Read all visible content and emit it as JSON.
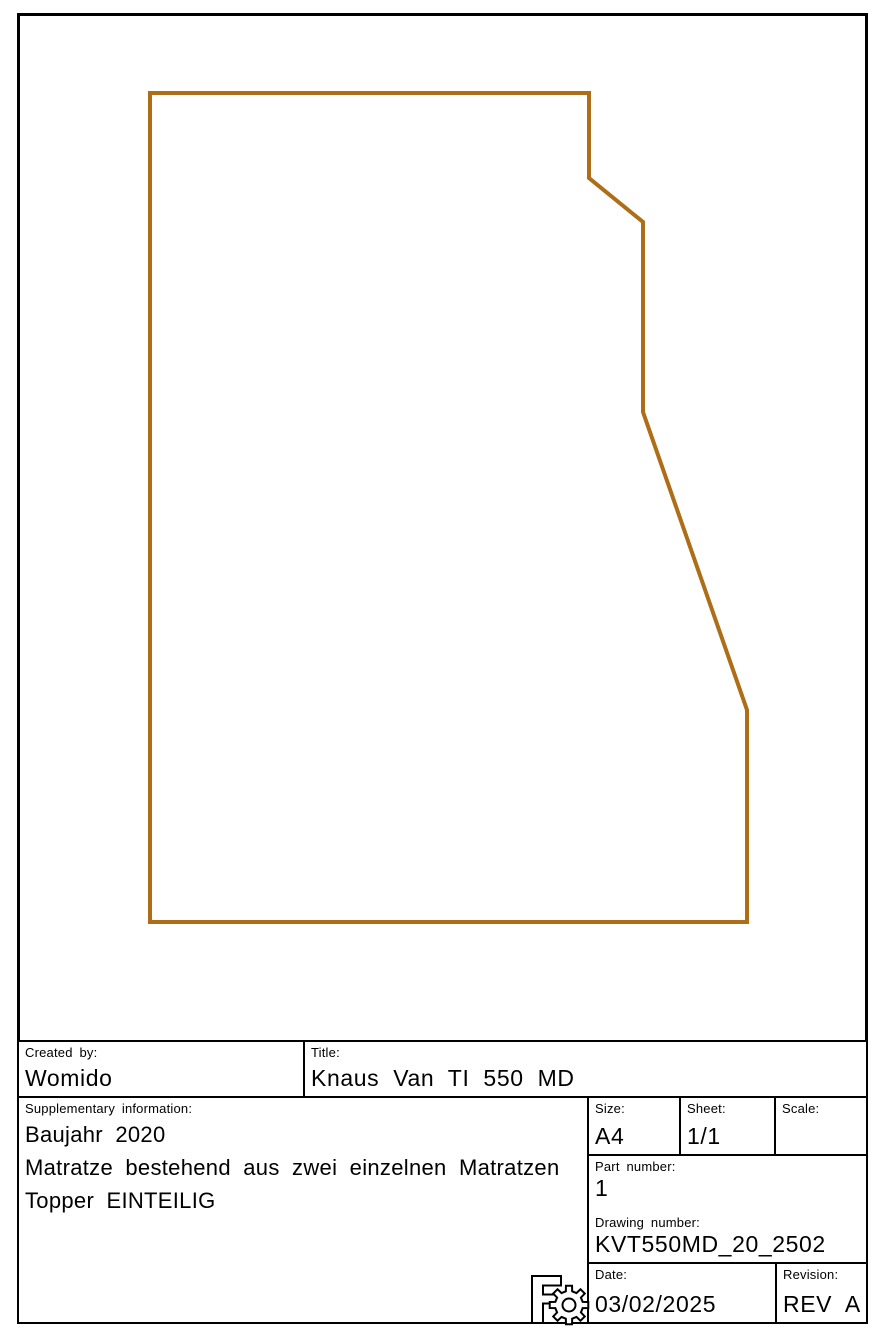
{
  "drawing": {
    "outline_color": "#AE6E17",
    "outline_points": "150,93 589,93 589,178 643,222 643,412 747,710 747,922 150,922",
    "outline_stroke_width": "4"
  },
  "title_block": {
    "created_by": {
      "label": "Created by:",
      "value": "Womido"
    },
    "title": {
      "label": "Title:",
      "value": "Knaus Van TI 550 MD"
    },
    "supplementary": {
      "label": "Supplementary information:",
      "lines": [
        "Baujahr 2020",
        "Matratze bestehend aus zwei einzelnen Matratzen",
        "Topper EINTEILIG"
      ]
    },
    "size": {
      "label": "Size:",
      "value": "A4"
    },
    "sheet": {
      "label": "Sheet:",
      "value": "1/1"
    },
    "scale": {
      "label": "Scale:",
      "value": ""
    },
    "part_number": {
      "label": "Part number:",
      "value": "1"
    },
    "drawing_number": {
      "label": "Drawing number:",
      "value": "KVT550MD_20_2502"
    },
    "date": {
      "label": "Date:",
      "value": "03/02/2025"
    },
    "revision": {
      "label": "Revision:",
      "value": "REV A"
    }
  },
  "colors": {
    "line_black": "#000000",
    "background": "#ffffff"
  },
  "icons": {
    "freecad_gear": "freecad-gear-icon"
  }
}
